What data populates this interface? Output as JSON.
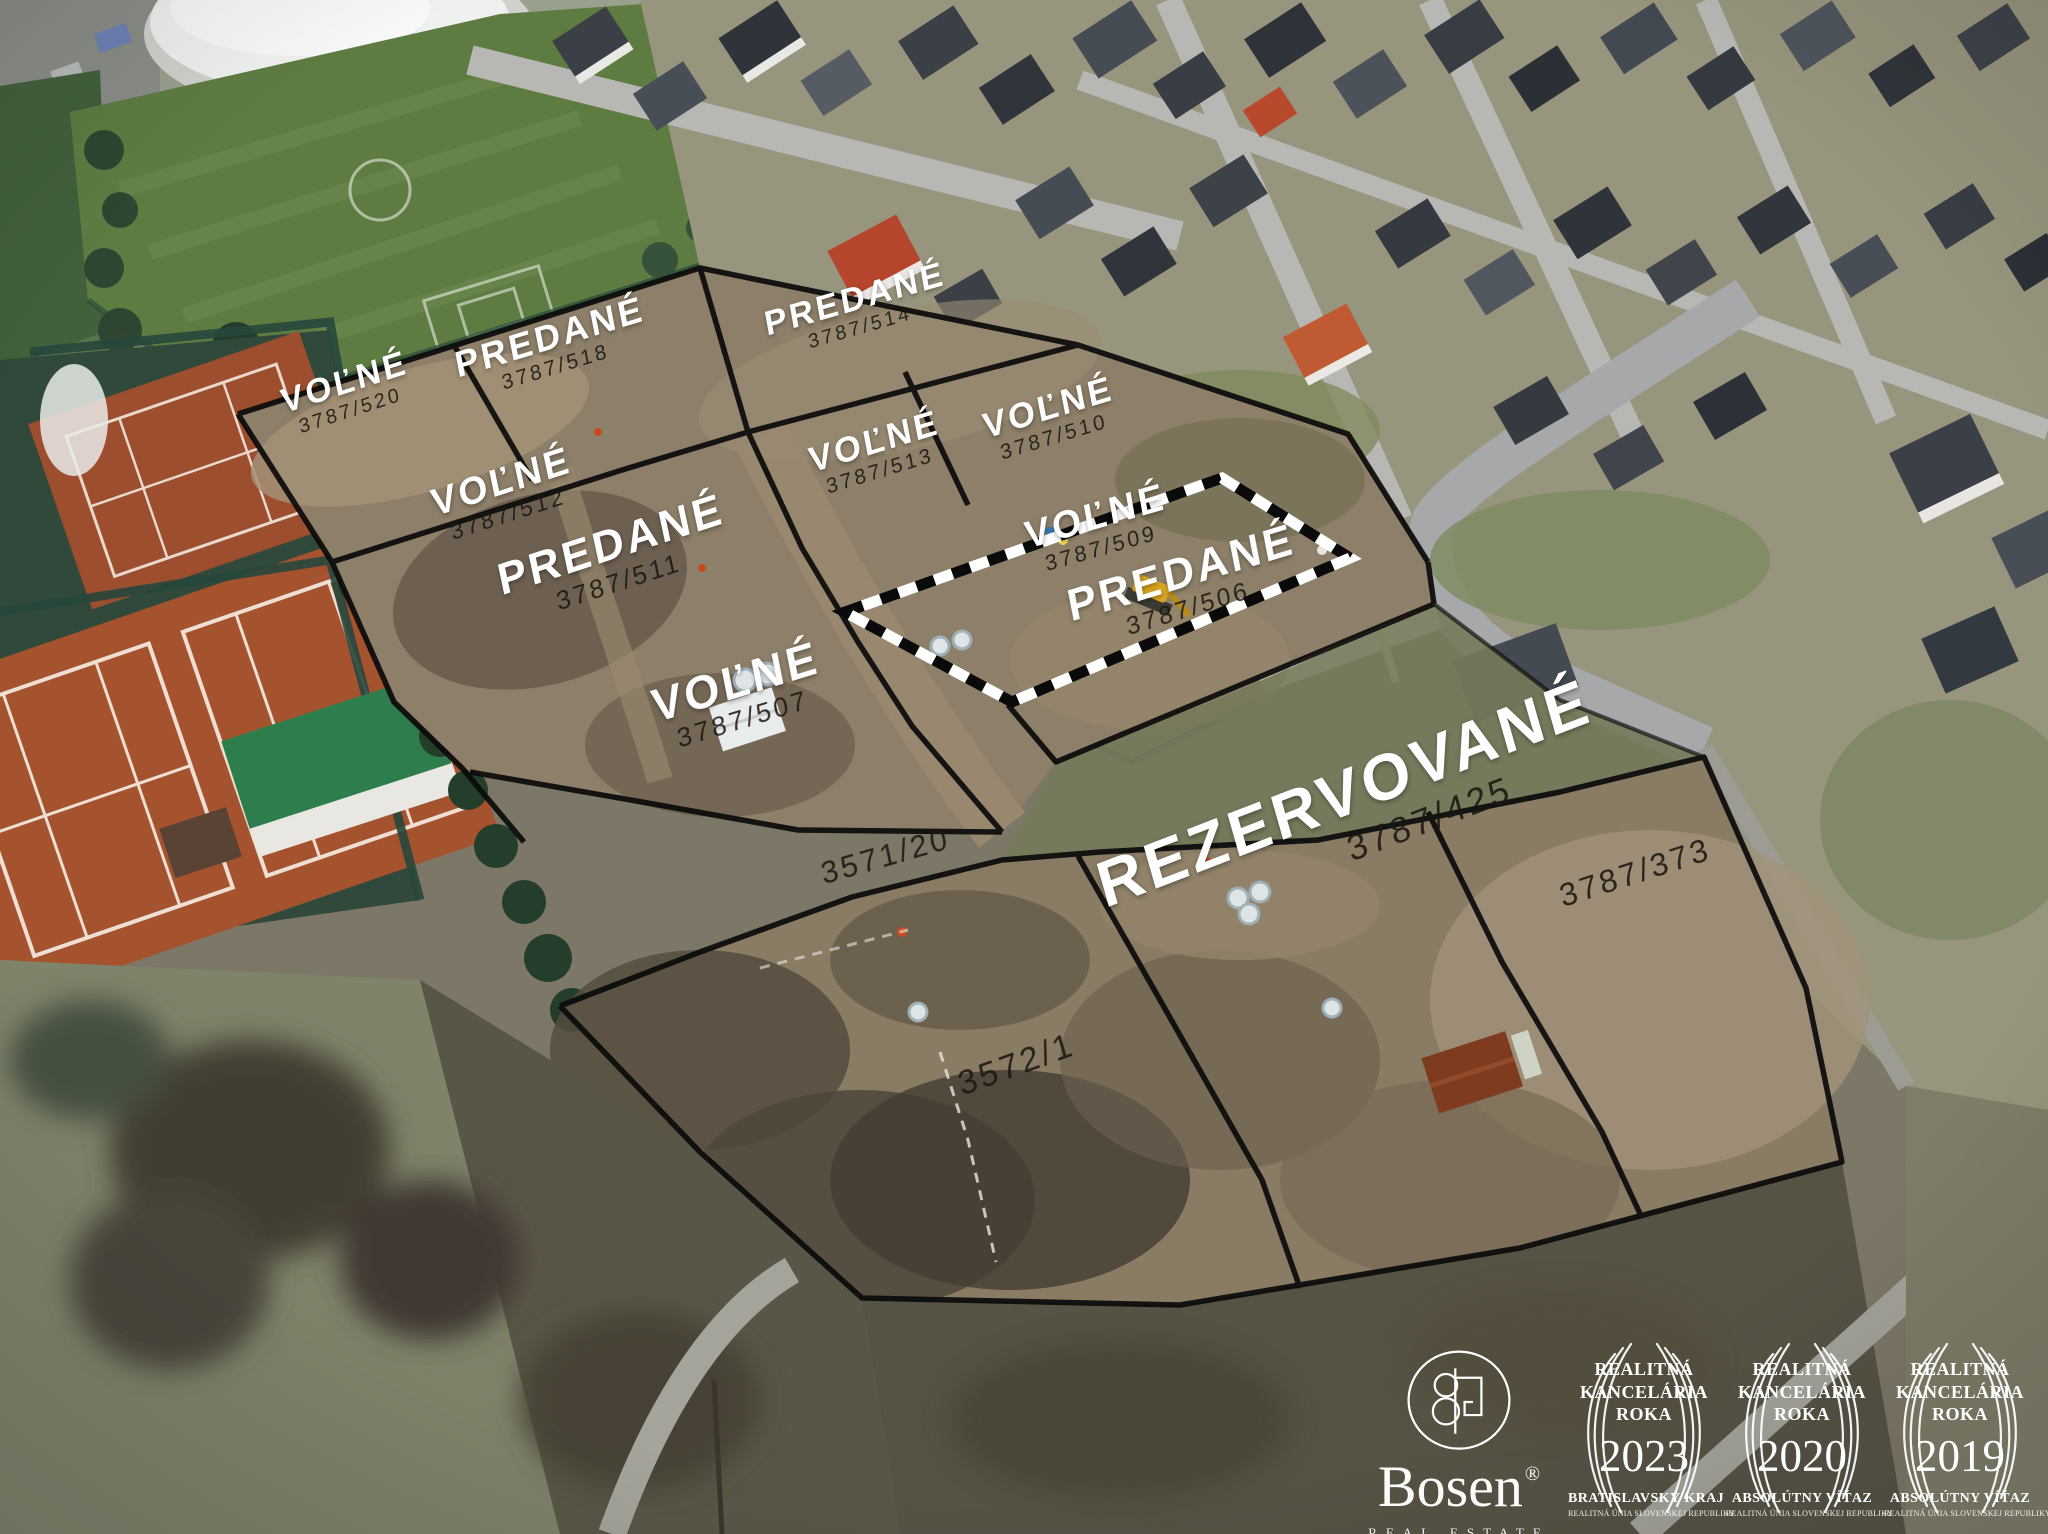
{
  "image": {
    "type": "aerial-drone-photo",
    "subject": "Development land plots beside sports grounds and residential neighbourhood"
  },
  "colors": {
    "status_label": "#ffffff",
    "plot_number": "#1b1712",
    "boundary_line": "#0a0a0a",
    "dashed_boundary_white": "#ffffff"
  },
  "plots": [
    {
      "status": "VOĽNÉ",
      "number": "3787/520"
    },
    {
      "status": "PREDANÉ",
      "number": "3787/518"
    },
    {
      "status": "PREDANÉ",
      "number": "3787/514"
    },
    {
      "status": "VOĽNÉ",
      "number": "3787/513"
    },
    {
      "status": "VOĽNÉ",
      "number": "3787/510"
    },
    {
      "status": "VOĽNÉ",
      "number": "3787/512"
    },
    {
      "status": "PREDANÉ",
      "number": "3787/511"
    },
    {
      "status": "VOĽNÉ",
      "number": "3787/509"
    },
    {
      "status": "PREDANÉ",
      "number": "3787/506"
    },
    {
      "status": "VOĽNÉ",
      "number": "3787/507"
    },
    {
      "status": "",
      "number": "3571/20"
    },
    {
      "status": "REZERVOVANÉ",
      "number": "3787/425"
    },
    {
      "status": "",
      "number": "3787/373"
    },
    {
      "status": "",
      "number": "3572/1"
    }
  ],
  "watermark": {
    "brand": "Bosen",
    "registered": "®",
    "tagline": "REAL ESTATE",
    "awards": [
      {
        "title1": "REALITNÁ",
        "title2": "KANCELÁRIA",
        "title3": "ROKA",
        "year": "2023",
        "subtitle": "BRATISLAVSKÝ KRAJ",
        "org": "REALITNÁ ÚNIA SLOVENSKEJ REPUBLIKY"
      },
      {
        "title1": "REALITNÁ",
        "title2": "KANCELÁRIA",
        "title3": "ROKA",
        "year": "2020",
        "subtitle": "ABSOLÚTNY VÍŤAZ",
        "org": "REALITNÁ ÚNIA SLOVENSKEJ REPUBLIKY"
      },
      {
        "title1": "REALITNÁ",
        "title2": "KANCELÁRIA",
        "title3": "ROKA",
        "year": "2019",
        "subtitle": "ABSOLÚTNY VÍŤAZ",
        "org": "REALITNÁ ÚNIA SLOVENSKEJ REPUBLIKY"
      }
    ]
  }
}
